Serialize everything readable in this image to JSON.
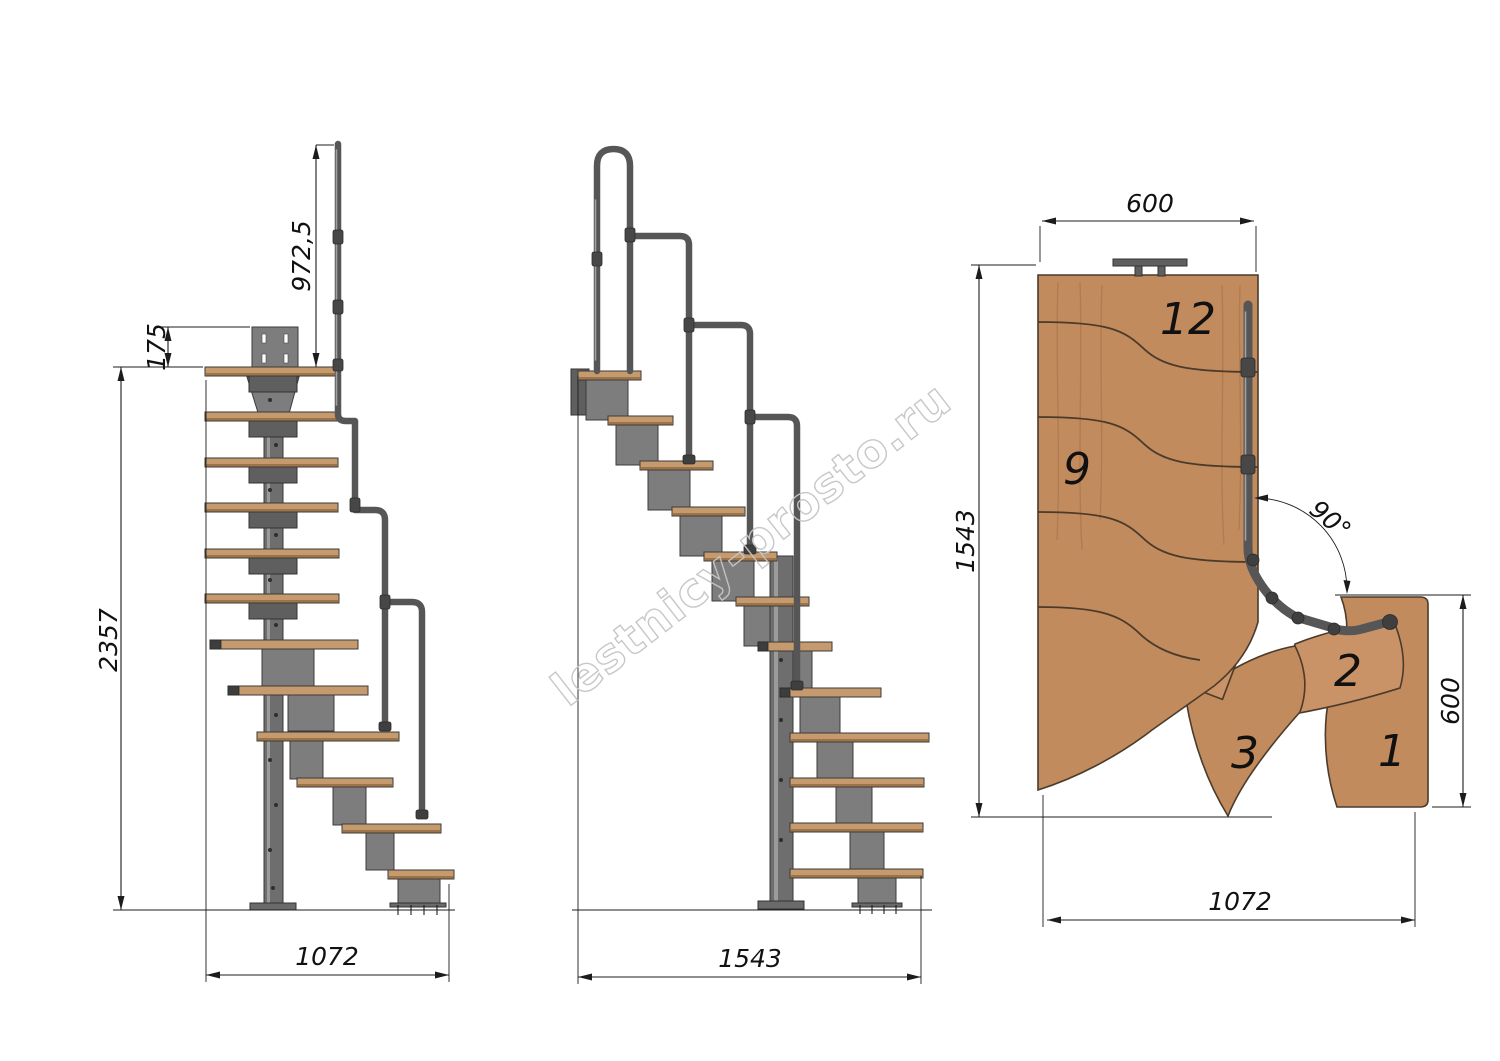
{
  "watermark": {
    "text": "lestnicy-prosto.ru"
  },
  "views": {
    "side_front": {
      "dims": {
        "rail_height": "972,5",
        "plate_offset": "175",
        "total_height": "2357",
        "base_length": "1072"
      }
    },
    "side_profile": {
      "dims": {
        "base_length": "1543"
      }
    },
    "plan": {
      "dims": {
        "top_width": "600",
        "side_length": "1543",
        "entry_width": "600",
        "bottom_length": "1072",
        "turn_angle": "90°"
      },
      "step_labels": {
        "top": "12",
        "mid": "9",
        "second": "2",
        "third": "3",
        "first": "1"
      }
    }
  }
}
